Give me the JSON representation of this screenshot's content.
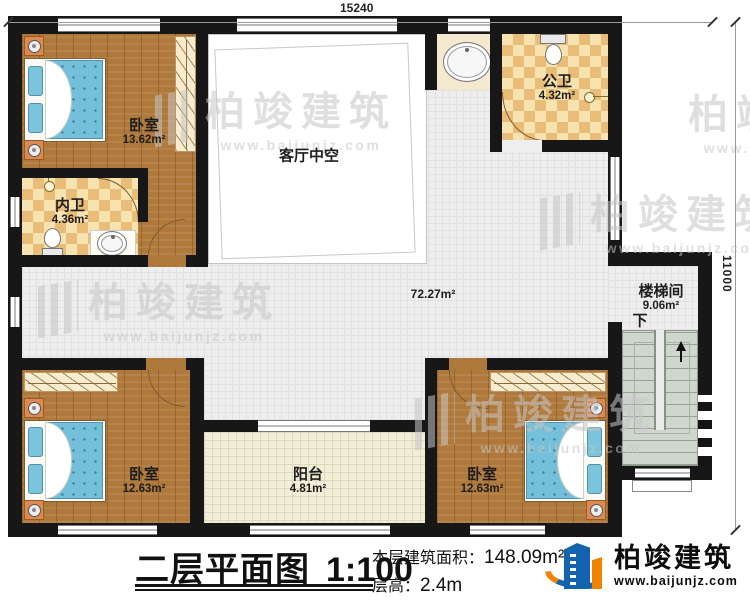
{
  "dimensions": {
    "width_mm": "15240",
    "height_mm": "11000"
  },
  "rooms": {
    "bedroom_top": {
      "name": "卧室",
      "area": "13.62m²"
    },
    "inner_bath": {
      "name": "内卫",
      "area": "4.36m²"
    },
    "living_void": {
      "name": "客厅中空"
    },
    "public_bath": {
      "name": "公卫",
      "area": "4.32m²"
    },
    "hallway": {
      "area": "72.27m²"
    },
    "stairwell": {
      "name": "楼梯间",
      "area": "9.06m²",
      "direction_label": "下"
    },
    "balcony": {
      "name": "阳台",
      "area": "4.81m²"
    },
    "bedroom_left": {
      "name": "卧室",
      "area": "12.63m²"
    },
    "bedroom_right": {
      "name": "卧室",
      "area": "12.63m²"
    }
  },
  "title_block": {
    "title": "二层平面图",
    "scale": "1:100",
    "area_label": "本层建筑面积：",
    "area_value": "148.09m²",
    "height_label": "层高：",
    "height_value": "2.4m",
    "brand": "柏竣建筑",
    "website": "www.baijunjz.com"
  },
  "watermark": {
    "brand": "柏竣建筑",
    "website": "www.baijunjz.com"
  },
  "colors": {
    "wall": "#171717",
    "wood_floor": "#b0793c",
    "bath_checker": "#e9bd77",
    "hall_tile": "#eeeeef",
    "balcony_floor": "#f1eeda",
    "stair_floor": "#cfd6cd",
    "bed_blue": "#74c0da",
    "nightstand_orange": "#dd8a52",
    "logo_blue": "#1463ae",
    "logo_orange": "#f08300"
  }
}
